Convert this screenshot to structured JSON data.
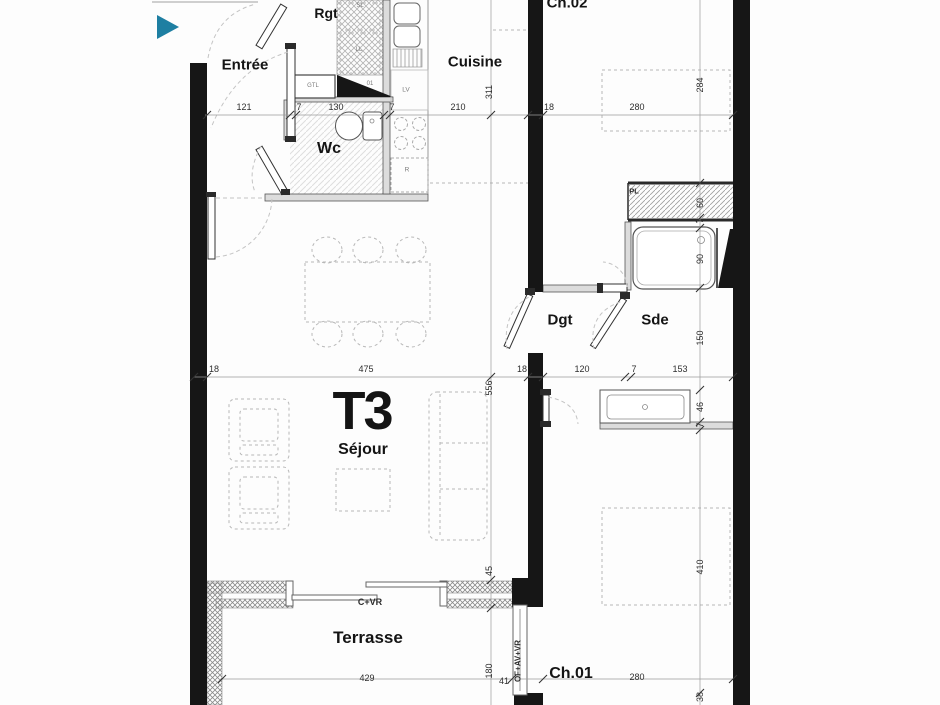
{
  "app": {
    "marker_color": "#1e7fa2",
    "wall_color": "#161616"
  },
  "plan": {
    "unit": "T3",
    "rooms": [
      {
        "id": "entree",
        "label": "Entrée",
        "x": 245,
        "y": 65,
        "fs": 15
      },
      {
        "id": "rgt",
        "label": "Rgt",
        "x": 326,
        "y": 13,
        "fs": 14
      },
      {
        "id": "cuisine",
        "label": "Cuisine",
        "x": 475,
        "y": 62,
        "fs": 15
      },
      {
        "id": "ch02",
        "label": "Ch.02",
        "x": 567,
        "y": 3,
        "fs": 15
      },
      {
        "id": "wc",
        "label": "Wc",
        "x": 329,
        "y": 149,
        "fs": 16
      },
      {
        "id": "dgt",
        "label": "Dgt",
        "x": 560,
        "y": 320,
        "fs": 15
      },
      {
        "id": "sde",
        "label": "Sde",
        "x": 655,
        "y": 320,
        "fs": 15
      },
      {
        "id": "t3",
        "label": "T3",
        "x": 362,
        "y": 411,
        "fs": 54
      },
      {
        "id": "sejour",
        "label": "Séjour",
        "x": 363,
        "y": 450,
        "fs": 16
      },
      {
        "id": "terrasse",
        "label": "Terrasse",
        "x": 368,
        "y": 638,
        "fs": 17
      },
      {
        "id": "ch01",
        "label": "Ch.01",
        "x": 571,
        "y": 674,
        "fs": 16
      }
    ],
    "annotations": [
      {
        "id": "gtl",
        "label": "GTL",
        "x": 313,
        "y": 86,
        "fs": 6,
        "strong": false,
        "vertical": false
      },
      {
        "id": "sl",
        "label": "SL",
        "x": 360,
        "y": 6,
        "fs": 6,
        "strong": false,
        "vertical": false
      },
      {
        "id": "ll",
        "label": "LL",
        "x": 359,
        "y": 50,
        "fs": 6,
        "strong": false,
        "vertical": false
      },
      {
        "id": "lv",
        "label": "LV",
        "x": 406,
        "y": 90,
        "fs": 6.5,
        "strong": false,
        "vertical": false
      },
      {
        "id": "r",
        "label": "R",
        "x": 407,
        "y": 170,
        "fs": 6.5,
        "strong": false,
        "vertical": false
      },
      {
        "id": "num01",
        "label": "01",
        "x": 370,
        "y": 84,
        "fs": 6,
        "strong": false,
        "vertical": false
      },
      {
        "id": "pl",
        "label": "PL",
        "x": 634,
        "y": 191,
        "fs": 7.5,
        "strong": true,
        "vertical": false
      },
      {
        "id": "cvr",
        "label": "C+VR",
        "x": 370,
        "y": 602,
        "fs": 9,
        "strong": true,
        "vertical": false
      },
      {
        "id": "ofavvr",
        "label": "OF+AV+VR",
        "x": 518,
        "y": 661,
        "fs": 8,
        "strong": true,
        "vertical": true
      }
    ],
    "dimensions": {
      "top": [
        {
          "label": "121",
          "x": 244,
          "y": 107
        },
        {
          "label": "7",
          "x": 299,
          "y": 107
        },
        {
          "label": "130",
          "x": 336,
          "y": 107
        },
        {
          "label": "7",
          "x": 392,
          "y": 107
        },
        {
          "label": "210",
          "x": 458,
          "y": 107
        },
        {
          "label": "18",
          "x": 549,
          "y": 107
        },
        {
          "label": "280",
          "x": 637,
          "y": 107
        }
      ],
      "middle": [
        {
          "label": "18",
          "x": 214,
          "y": 369
        },
        {
          "label": "475",
          "x": 366,
          "y": 369
        },
        {
          "label": "18",
          "x": 522,
          "y": 369
        },
        {
          "label": "120",
          "x": 582,
          "y": 369
        },
        {
          "label": "7",
          "x": 634,
          "y": 369
        },
        {
          "label": "153",
          "x": 680,
          "y": 369
        }
      ],
      "bottom": [
        {
          "label": "429",
          "x": 367,
          "y": 678
        },
        {
          "label": "41",
          "x": 504,
          "y": 681
        },
        {
          "label": "280",
          "x": 637,
          "y": 677
        }
      ],
      "right_vertical": [
        {
          "label": "284",
          "x": 700,
          "y": 85
        },
        {
          "label": "60",
          "x": 700,
          "y": 203
        },
        {
          "label": "7",
          "x": 700,
          "y": 221
        },
        {
          "label": "90",
          "x": 700,
          "y": 259
        },
        {
          "label": "150",
          "x": 700,
          "y": 338
        },
        {
          "label": "46",
          "x": 700,
          "y": 407
        },
        {
          "label": "7",
          "x": 700,
          "y": 425
        },
        {
          "label": "410",
          "x": 700,
          "y": 567
        },
        {
          "label": "38",
          "x": 700,
          "y": 697
        }
      ],
      "center_vertical": [
        {
          "label": "311",
          "x": 489,
          "y": 92
        },
        {
          "label": "556",
          "x": 489,
          "y": 388
        },
        {
          "label": "45",
          "x": 489,
          "y": 571
        },
        {
          "label": "180",
          "x": 489,
          "y": 671
        }
      ]
    }
  }
}
